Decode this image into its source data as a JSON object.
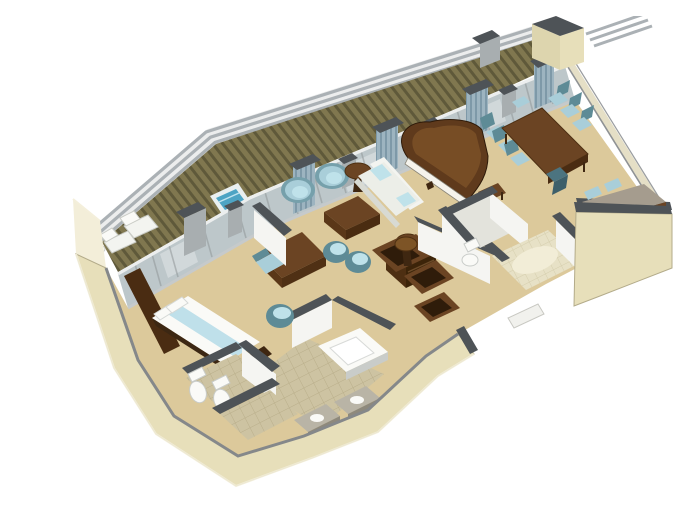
{
  "meta": {
    "title": "Isometric 3D cutaway floor plan rendering of a penthouse suite with private veranda",
    "visible_text": "none"
  },
  "colors": {
    "background": "#ffffff",
    "floor_carpet": "#dcc99b",
    "floor_tile": "#cdc3a2",
    "tile_grout": "#b9ae8a",
    "entry_tile": "#e7e1c6",
    "entry_grout": "#d5cead",
    "rug": "#f2edd7",
    "hull_cream": "#e7dfba",
    "hull_cream_light": "#f3eed9",
    "hull_edge": "#a79f7f",
    "inner_lip": "#85888a",
    "wall_cap": "#4e5357",
    "wall_gray": "#a8aeb0",
    "wall_white": "#f5f5f2",
    "wall_shadow": "#ddd5ae",
    "glass": "#b7c2c6",
    "glass_light": "#dde3e5",
    "frame": "#8f9598",
    "curtain": "#9db4c0",
    "curtain_dark": "#7e99a8",
    "deck_base": "#80774f",
    "deck_stripe": "#5f593a",
    "railing": "#abb1b5",
    "hottub": "#4da4c4",
    "hottub_rim": "#e9eff0",
    "wood": "#6b4423",
    "wood_dark": "#3f2711",
    "wood_light": "#7d5426",
    "desk_top": "#a59c8e",
    "chair_blue": "#a9ced9",
    "chair_teal": "#5e8b96",
    "seat_light": "#bfe2ea",
    "sofa": "#f3f4f0",
    "sofa_shadow": "#d8dad3",
    "bed": "#bfe0ea",
    "fixture": "#fafaf7",
    "fixture_shadow": "#c9ccc9"
  },
  "scene": {
    "setting": "isometric cutaway architectural rendering, no text labels",
    "rooms": [
      {
        "name": "veranda",
        "items": [
          "whirlpool tub",
          "2 chaise lounges",
          "wood plank decking",
          "deck railing"
        ]
      },
      {
        "name": "living-room",
        "items": [
          "white sofa with cushions",
          "2 barrel armchairs",
          "coffee table",
          "2 round side tables",
          "2 tub chairs",
          "minibar cabinet"
        ]
      },
      {
        "name": "music-corner",
        "items": [
          "grand piano",
          "piano bench"
        ]
      },
      {
        "name": "dining-area",
        "items": [
          "dining table",
          "8 dining chairs"
        ]
      },
      {
        "name": "office-nook",
        "items": [
          "writing desk",
          "2 desk chairs"
        ]
      },
      {
        "name": "entry-foyer",
        "items": [
          "tiled floor",
          "oval rug",
          "entrance opening"
        ]
      },
      {
        "name": "guest-bathroom",
        "items": [
          "toilet"
        ]
      },
      {
        "name": "walk-in-closet",
        "items": [
          "3 open shelf units",
          "round stool"
        ]
      },
      {
        "name": "master-bathroom",
        "items": [
          "bathtub",
          "2 vanity sinks",
          "tub chair",
          "tiled floor"
        ]
      },
      {
        "name": "water-closet",
        "items": [
          "toilet",
          "bidet"
        ]
      },
      {
        "name": "shower-room",
        "items": [
          "tiled floor"
        ]
      },
      {
        "name": "master-bedroom",
        "items": [
          "double bed with blue runner",
          "headboard wall",
          "vanity desk",
          "desk chair",
          "sliding glass doors to veranda"
        ]
      }
    ]
  }
}
